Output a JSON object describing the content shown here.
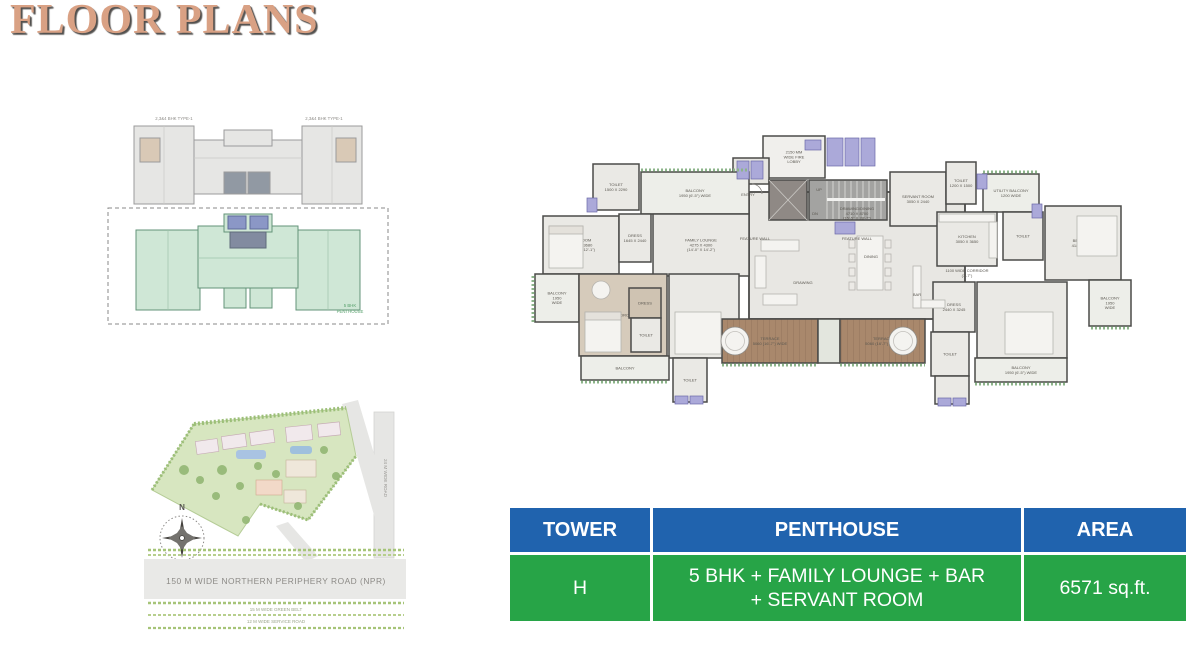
{
  "page": {
    "title": "FLOOR PLANS"
  },
  "key_plan": {
    "label_left": "2,3&4 BHK TYPE-1",
    "label_right": "2,3&4 BHK TYPE-1",
    "caption_line1": "5 BHK",
    "caption_line2": "PENTHOUSE"
  },
  "site_map": {
    "north": "N",
    "npr_road": "150 M  WIDE NORTHERN PERIPHERY ROAD (NPR)",
    "green_belt": "15 M WIDE GREEN BELT",
    "service_road": "12 M WIDE SERVICE ROAD",
    "side_road": "24 M WIDE ROAD"
  },
  "floor_plan": {
    "rooms": [
      {
        "id": "fire-lobby",
        "x": 258,
        "y": 92,
        "w": 62,
        "h": 42,
        "fill": "#f0efec",
        "lines": [
          "2150 MM",
          "WIDE FIRE",
          "LOBBY"
        ]
      },
      {
        "id": "entry-toilet",
        "x": 228,
        "y": 114,
        "w": 36,
        "h": 26,
        "fill": "#e6e5e1",
        "lines": []
      },
      {
        "id": "drawing-dining-hall",
        "x": 244,
        "y": 148,
        "w": 216,
        "h": 127,
        "fill": "#e8e7e3",
        "sw": 1.8,
        "lines": []
      },
      {
        "id": "toilet-left-top",
        "x": 88,
        "y": 120,
        "w": 46,
        "h": 46,
        "lines": [
          "TOILET",
          "1500 X 2290"
        ]
      },
      {
        "id": "balcony-top-left",
        "x": 136,
        "y": 128,
        "w": 108,
        "h": 42,
        "fill": "#edeee9",
        "lines": [
          "BALCONY",
          "1950 (6'-5\") WIDE"
        ]
      },
      {
        "id": "bedroom-left-top",
        "x": 38,
        "y": 172,
        "w": 76,
        "h": 58,
        "lines": [
          "BEDROOM",
          "3145 X 3680",
          "(10'-4\" X 12'-1\")"
        ]
      },
      {
        "id": "dress-left",
        "x": 114,
        "y": 170,
        "w": 32,
        "h": 48,
        "lines": [
          "DRESS",
          "1645 X 2440"
        ]
      },
      {
        "id": "family-lounge",
        "x": 148,
        "y": 170,
        "w": 96,
        "h": 62,
        "lines": [
          "FAMILY LOUNGE",
          "4275 X 4300",
          "(14'-0\" X 14'-2\")"
        ]
      },
      {
        "id": "balcony-left",
        "x": 30,
        "y": 230,
        "w": 44,
        "h": 48,
        "fill": "#edeee9",
        "lines": [
          "BALCONY",
          "1950",
          "WIDE"
        ]
      },
      {
        "id": "master-bedroom",
        "x": 74,
        "y": 230,
        "w": 88,
        "h": 82,
        "fill": "#d6cbbb",
        "lines": [
          "M.BEDROOM"
        ]
      },
      {
        "id": "dress-master",
        "x": 124,
        "y": 244,
        "w": 32,
        "h": 30,
        "fill": "#cfc3b2",
        "lines": [
          "DRESS"
        ]
      },
      {
        "id": "toilet-master",
        "x": 126,
        "y": 274,
        "w": 30,
        "h": 34,
        "lines": [
          "TOILET"
        ]
      },
      {
        "id": "bedroom-left-bottom",
        "x": 164,
        "y": 230,
        "w": 70,
        "h": 84,
        "lines": [
          "BEDROOM",
          "3600 X 3890"
        ]
      },
      {
        "id": "balcony-bottom-left",
        "x": 76,
        "y": 312,
        "w": 88,
        "h": 24,
        "fill": "#edeee9",
        "lines": [
          "BALCONY"
        ]
      },
      {
        "id": "toilet-bottom-left",
        "x": 168,
        "y": 314,
        "w": 34,
        "h": 44,
        "lines": [
          "TOILET"
        ]
      },
      {
        "id": "terrace-1",
        "x": 217,
        "y": 275,
        "w": 96,
        "h": 44,
        "fill": "url(#plank)",
        "tc": "#463c30",
        "lines": [
          "TERRACE",
          "5060 (16'-7\") WIDE"
        ]
      },
      {
        "id": "terrace-planter",
        "x": 313,
        "y": 275,
        "w": 22,
        "h": 44,
        "fill": "#e3e6de",
        "lines": []
      },
      {
        "id": "terrace-2",
        "x": 335,
        "y": 275,
        "w": 85,
        "h": 44,
        "fill": "url(#plank)",
        "tc": "#463c30",
        "lines": [
          "TERRACE",
          "5060 (16'-7\") WIDE"
        ]
      },
      {
        "id": "lift-lobby",
        "x": 264,
        "y": 136,
        "w": 38,
        "h": 40,
        "fill": "#8f8985",
        "lines": []
      },
      {
        "id": "staircase",
        "x": 304,
        "y": 136,
        "w": 78,
        "h": 40,
        "fill": "#a3a3a1",
        "lines": []
      },
      {
        "id": "servant-room",
        "x": 385,
        "y": 128,
        "w": 56,
        "h": 54,
        "lines": [
          "SERVANT ROOM",
          "3050 X 2440"
        ]
      },
      {
        "id": "toilet-right-top",
        "x": 441,
        "y": 118,
        "w": 30,
        "h": 42,
        "lines": [
          "TOILET",
          "1200 X 1500"
        ]
      },
      {
        "id": "utility-balcony",
        "x": 478,
        "y": 130,
        "w": 56,
        "h": 38,
        "fill": "#edeee9",
        "lines": [
          "UTILITY BALCONY",
          "1200 WIDE"
        ]
      },
      {
        "id": "kitchen",
        "x": 432,
        "y": 168,
        "w": 60,
        "h": 54,
        "lines": [
          "KITCHEN",
          "3050 X 3650"
        ]
      },
      {
        "id": "toilet-right-mid",
        "x": 498,
        "y": 168,
        "w": 40,
        "h": 48,
        "lines": [
          "TOILET"
        ]
      },
      {
        "id": "bedroom-right-top",
        "x": 540,
        "y": 162,
        "w": 76,
        "h": 74,
        "lines": [
          "BEDROOM",
          "4180 X 3660"
        ]
      },
      {
        "id": "balcony-right",
        "x": 584,
        "y": 236,
        "w": 42,
        "h": 46,
        "fill": "#edeee9",
        "lines": [
          "BALCONY",
          "1950",
          "WIDE"
        ]
      },
      {
        "id": "dress-right",
        "x": 428,
        "y": 238,
        "w": 42,
        "h": 50,
        "lines": [
          "DRESS",
          "2440 X 3245"
        ]
      },
      {
        "id": "bedroom-right-bottom",
        "x": 472,
        "y": 238,
        "w": 90,
        "h": 76,
        "lines": [
          "BEDROOM",
          "4180 X 3660",
          "(13'-8\" X 12'-0\")"
        ]
      },
      {
        "id": "toilet-right-bottom",
        "x": 426,
        "y": 288,
        "w": 38,
        "h": 44,
        "lines": [
          "TOILET"
        ]
      },
      {
        "id": "balcony-bottom-right",
        "x": 470,
        "y": 314,
        "w": 92,
        "h": 24,
        "fill": "#edeee9",
        "lines": [
          "BALCONY",
          "1950 (6'-5\") WIDE"
        ]
      },
      {
        "id": "utility-bottom-right",
        "x": 430,
        "y": 332,
        "w": 34,
        "h": 28,
        "lines": []
      }
    ],
    "labels": [
      {
        "id": "drawing-dining",
        "x": 352,
        "y": 166,
        "lines": [
          "DRAWING/DINING",
          "4710 X 8700",
          "(15'-5\" X 28'-7\")"
        ]
      },
      {
        "id": "drawing",
        "x": 298,
        "y": 240,
        "lines": [
          "DRAWING"
        ]
      },
      {
        "id": "dining",
        "x": 366,
        "y": 214,
        "lines": [
          "DINING"
        ]
      },
      {
        "id": "bar",
        "x": 412,
        "y": 252,
        "lines": [
          "BAR"
        ]
      },
      {
        "id": "corridor",
        "x": 462,
        "y": 228,
        "lines": [
          "1100 WIDE CORRIDOR",
          "(3'-7\")"
        ]
      },
      {
        "id": "feature-wall-left",
        "x": 250,
        "y": 196,
        "lines": [
          "FEATURE WALL"
        ]
      },
      {
        "id": "feature-wall-right",
        "x": 352,
        "y": 196,
        "lines": [
          "FEATURE WALL"
        ]
      },
      {
        "id": "entry",
        "x": 243,
        "y": 152,
        "color": "#b23b30",
        "lines": [
          "ENTRY"
        ]
      },
      {
        "id": "stair-up",
        "x": 314,
        "y": 147,
        "color": "#2f2f2d",
        "lines": [
          "UP"
        ]
      },
      {
        "id": "stair-dn",
        "x": 310,
        "y": 171,
        "color": "#2f2f2d",
        "lines": [
          "DN"
        ]
      }
    ]
  },
  "table": {
    "headers": [
      "TOWER",
      "PENTHOUSE",
      "AREA"
    ],
    "row": {
      "tower": "H",
      "penthouse_line1": "5 BHK + FAMILY LOUNGE + BAR",
      "penthouse_line2": "+ SERVANT ROOM",
      "area": "6571 sq.ft."
    },
    "header_color": "#2063ae",
    "row_color": "#27a447"
  },
  "colors": {
    "title": "#d9a184",
    "wall": "#4b4b49",
    "floor": "#eae9e5",
    "terrace": "#a9886c",
    "fixture_purple": "#aba9d9",
    "plant_green": "#8cb48a"
  }
}
